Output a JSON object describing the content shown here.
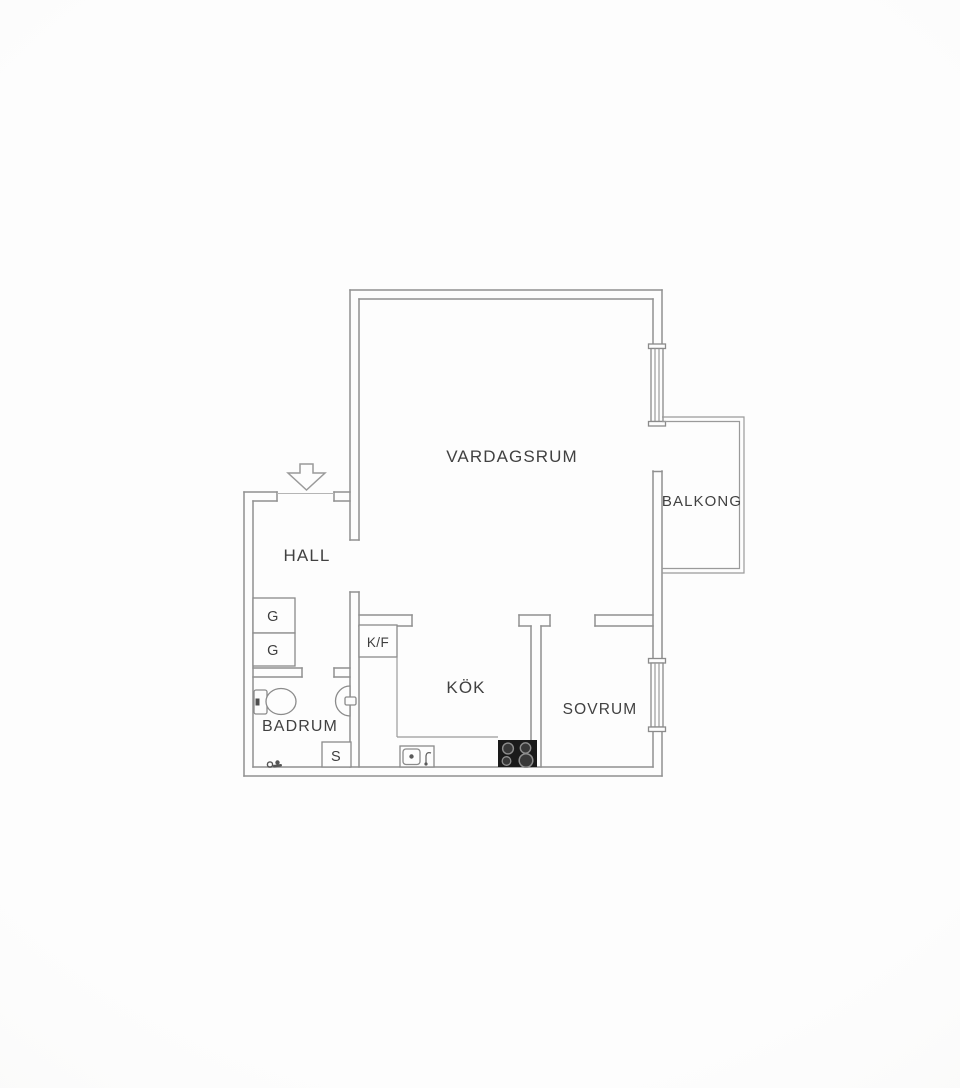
{
  "rooms": {
    "vardagsrum": {
      "label": "VARDAGSRUM"
    },
    "balkong": {
      "label": "BALKONG"
    },
    "hall": {
      "label": "HALL"
    },
    "kok": {
      "label": "KÖK"
    },
    "sovrum": {
      "label": "SOVRUM"
    },
    "badrum": {
      "label": "BADRUM"
    }
  },
  "fixtures": {
    "wardrobe1": {
      "label": "G"
    },
    "wardrobe2": {
      "label": "G"
    },
    "fridge_freezer": {
      "label": "K/F"
    },
    "cabinet": {
      "label": "S"
    }
  },
  "colors": {
    "wall_line": "#909090",
    "label_text": "#414141",
    "stove": "#1a1a1a",
    "background": "#fcfcfc"
  }
}
